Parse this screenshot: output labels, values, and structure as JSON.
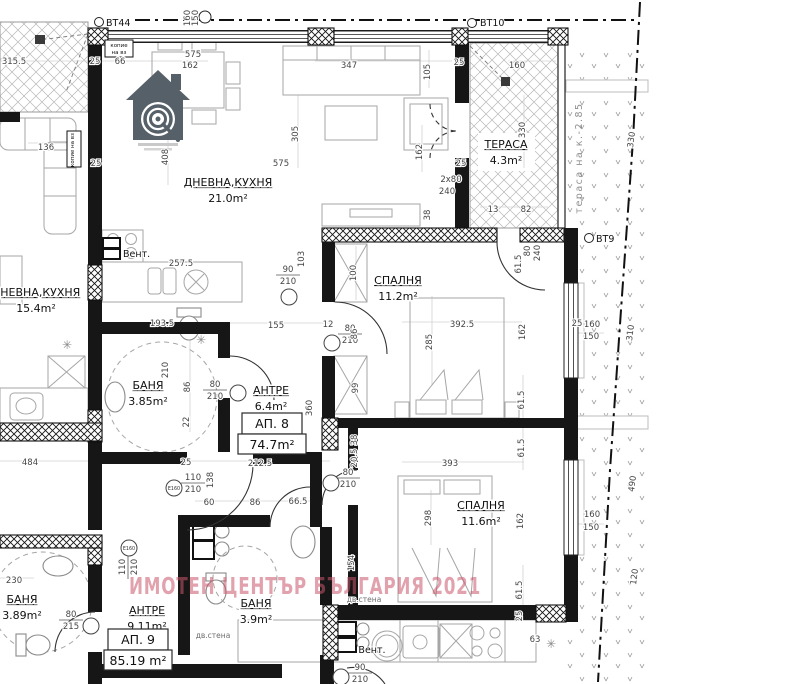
{
  "watermark": {
    "text": "ИМОТЕН ЦЕНТЪР БЪЛГАРИЯ 2021",
    "color": "#c9566b"
  },
  "logo": {
    "icon": "house-target-logo"
  },
  "rooms": [
    {
      "id": "living-21",
      "name": "ДНЕВНА,КУХНЯ",
      "area": "21.0m²",
      "x": 228,
      "y": 186
    },
    {
      "id": "terrace-4-3",
      "name": "ТЕРАСА",
      "area": "4.3m²",
      "x": 506,
      "y": 148
    },
    {
      "id": "living-15-4",
      "name": "ДНЕВНА,КУХНЯ",
      "area": "15.4m²",
      "x": 36,
      "y": 296
    },
    {
      "id": "bedroom-11-2",
      "name": "СПАЛНЯ",
      "area": "11.2m²",
      "x": 398,
      "y": 284
    },
    {
      "id": "bath-3-85",
      "name": "БАНЯ",
      "area": "3.85m²",
      "x": 148,
      "y": 389
    },
    {
      "id": "hall-6-4",
      "name": "АНТРЕ",
      "area": "6.4m²",
      "x": 271,
      "y": 394
    },
    {
      "id": "bedroom-11-6",
      "name": "СПАЛНЯ",
      "area": "11.6m²",
      "x": 481,
      "y": 509
    },
    {
      "id": "bath-3-89",
      "name": "БАНЯ",
      "area": "3.89m²",
      "x": 22,
      "y": 603
    },
    {
      "id": "hall-9-11",
      "name": "АНТРЕ",
      "area": "9.11m²",
      "x": 147,
      "y": 614
    },
    {
      "id": "bath-3-9",
      "name": "БАНЯ",
      "area": "3.9m²",
      "x": 256,
      "y": 607
    }
  ],
  "apartments": [
    {
      "label": "АП. 8",
      "area": "74.7m²",
      "x": 272,
      "y": 413
    },
    {
      "label": "АП. 9",
      "area": "85.19 m²",
      "x": 138,
      "y": 629
    }
  ],
  "annotations": [
    {
      "t": "ВТ44",
      "x": 106,
      "y": 26,
      "a": "start",
      "c": "ann"
    },
    {
      "t": "ВТ10",
      "x": 480,
      "y": 26,
      "a": "start",
      "c": "ann"
    },
    {
      "t": "ВТ9",
      "x": 596,
      "y": 242,
      "a": "start",
      "c": "ann"
    },
    {
      "t": "Вент.",
      "x": 123,
      "y": 257,
      "a": "start",
      "c": "ann"
    },
    {
      "t": "Вент.",
      "x": 372,
      "y": 653,
      "c": "ann"
    },
    {
      "t": "дв.стена",
      "x": 213,
      "y": 638,
      "c": "small-gray"
    },
    {
      "t": "дв.стена",
      "x": 364,
      "y": 602,
      "c": "small-gray"
    },
    {
      "t": "тераса на к.-2.85",
      "x": 582,
      "y": 158,
      "r": -90,
      "c": "gray-vert"
    },
    {
      "t": "копие",
      "x": 119,
      "y": 47,
      "c": "tiny"
    },
    {
      "t": "на вз",
      "x": 119,
      "y": 54,
      "c": "tiny"
    },
    {
      "t": "копие на вз",
      "x": 74,
      "y": 150,
      "r": -90,
      "c": "tiny"
    },
    {
      "t": "✳",
      "x": 201,
      "y": 344,
      "c": "lamp"
    },
    {
      "t": "✳",
      "x": 67,
      "y": 349,
      "c": "lamp"
    },
    {
      "t": "✳",
      "x": 551,
      "y": 648,
      "c": "lamp"
    }
  ],
  "dimensions": [
    {
      "t": "315.5",
      "x": 14,
      "y": 64
    },
    {
      "t": "25",
      "x": 95,
      "y": 64
    },
    {
      "t": "66",
      "x": 120,
      "y": 64
    },
    {
      "t": "575",
      "x": 193,
      "y": 57
    },
    {
      "t": "162",
      "x": 190,
      "y": 68
    },
    {
      "t": "347",
      "x": 349,
      "y": 68
    },
    {
      "t": "105",
      "x": 430,
      "y": 72,
      "r": -90
    },
    {
      "t": "305",
      "x": 298,
      "y": 134,
      "r": -90
    },
    {
      "t": "575",
      "x": 281,
      "y": 166
    },
    {
      "t": "408",
      "x": 168,
      "y": 157,
      "r": -90
    },
    {
      "t": "136",
      "x": 46,
      "y": 150
    },
    {
      "t": "25",
      "x": 96,
      "y": 166
    },
    {
      "t": "160",
      "x": 517,
      "y": 68
    },
    {
      "t": "330",
      "x": 525,
      "y": 130,
      "r": -90
    },
    {
      "t": "13",
      "x": 493,
      "y": 212
    },
    {
      "t": "82",
      "x": 526,
      "y": 212
    },
    {
      "t": "25",
      "x": 459,
      "y": 65
    },
    {
      "t": "162",
      "x": 422,
      "y": 152,
      "r": -90
    },
    {
      "t": "2x80",
      "x": 451,
      "y": 182
    },
    {
      "t": "240",
      "x": 447,
      "y": 194
    },
    {
      "t": "25",
      "x": 461,
      "y": 166
    },
    {
      "t": "38",
      "x": 430,
      "y": 215,
      "r": -90
    },
    {
      "t": "160",
      "x": 190,
      "y": 18,
      "r": -90
    },
    {
      "t": "150",
      "x": 198,
      "y": 18,
      "r": -90
    },
    {
      "t": "257.5",
      "x": 181,
      "y": 266
    },
    {
      "t": "193.5",
      "x": 162,
      "y": 326
    },
    {
      "t": "210",
      "x": 168,
      "y": 370,
      "r": -90
    },
    {
      "t": "86",
      "x": 190,
      "y": 387,
      "r": -90
    },
    {
      "t": "22",
      "x": 189,
      "y": 422,
      "r": -90
    },
    {
      "t": "103",
      "x": 304,
      "y": 259,
      "r": -90
    },
    {
      "t": "100",
      "x": 356,
      "y": 273,
      "r": -90
    },
    {
      "t": "155",
      "x": 276,
      "y": 328
    },
    {
      "t": "12",
      "x": 328,
      "y": 327
    },
    {
      "t": "86",
      "x": 357,
      "y": 334,
      "r": -90
    },
    {
      "t": "99",
      "x": 358,
      "y": 388,
      "r": -90
    },
    {
      "t": "360",
      "x": 312,
      "y": 408,
      "r": -90
    },
    {
      "t": "392.5",
      "x": 462,
      "y": 327
    },
    {
      "t": "285",
      "x": 432,
      "y": 342,
      "r": -90
    },
    {
      "t": "61.5",
      "x": 521,
      "y": 264,
      "r": -90
    },
    {
      "t": "80",
      "x": 530,
      "y": 251,
      "r": -90
    },
    {
      "t": "240",
      "x": 540,
      "y": 253,
      "r": -90
    },
    {
      "t": "162",
      "x": 525,
      "y": 332,
      "r": -90
    },
    {
      "t": "61.5",
      "x": 524,
      "y": 400,
      "r": -90
    },
    {
      "t": "61.5",
      "x": 524,
      "y": 448,
      "r": -90
    },
    {
      "t": "25",
      "x": 577,
      "y": 326
    },
    {
      "t": "160",
      "x": 592,
      "y": 327
    },
    {
      "t": "150",
      "x": 591,
      "y": 339
    },
    {
      "t": "330",
      "x": 634,
      "y": 140,
      "r": -83
    },
    {
      "t": "310",
      "x": 633,
      "y": 333,
      "r": -83
    },
    {
      "t": "490",
      "x": 635,
      "y": 484,
      "r": -83
    },
    {
      "t": "120",
      "x": 637,
      "y": 577,
      "r": -83
    },
    {
      "t": "38",
      "x": 357,
      "y": 440,
      "r": -90
    },
    {
      "t": "20.5",
      "x": 357,
      "y": 458,
      "r": -90
    },
    {
      "t": "212.5",
      "x": 260,
      "y": 466
    },
    {
      "t": "138",
      "x": 213,
      "y": 480,
      "r": -90
    },
    {
      "t": "25",
      "x": 186,
      "y": 465
    },
    {
      "t": "60",
      "x": 209,
      "y": 505
    },
    {
      "t": "86",
      "x": 255,
      "y": 505
    },
    {
      "t": "484",
      "x": 30,
      "y": 465
    },
    {
      "t": "230",
      "x": 14,
      "y": 583
    },
    {
      "t": "66.5",
      "x": 298,
      "y": 504
    },
    {
      "t": "393",
      "x": 450,
      "y": 466
    },
    {
      "t": "298",
      "x": 431,
      "y": 518,
      "r": -90
    },
    {
      "t": "162",
      "x": 523,
      "y": 521,
      "r": -90
    },
    {
      "t": "154",
      "x": 354,
      "y": 563,
      "r": -90
    },
    {
      "t": "61.5",
      "x": 522,
      "y": 590,
      "r": -90
    },
    {
      "t": "160",
      "x": 592,
      "y": 517
    },
    {
      "t": "150",
      "x": 591,
      "y": 530
    },
    {
      "t": "63",
      "x": 535,
      "y": 642
    },
    {
      "t": "25",
      "x": 522,
      "y": 616,
      "r": -90
    }
  ],
  "door_markers": [
    {
      "w": "90",
      "h": "210",
      "x": 288,
      "y": 272,
      "cx": 289,
      "cy": 297
    },
    {
      "w": "80",
      "h": "210",
      "x": 350,
      "y": 331,
      "cx": 332,
      "cy": 343
    },
    {
      "w": "80",
      "h": "210",
      "x": 215,
      "y": 387,
      "cx": 238,
      "cy": 393
    },
    {
      "w": "80",
      "h": "210",
      "x": 348,
      "y": 475,
      "cx": 331,
      "cy": 483
    },
    {
      "w": "80",
      "h": "215",
      "x": 71,
      "y": 617,
      "cx": 91,
      "cy": 626
    },
    {
      "w": "110",
      "h": "210",
      "x": 193,
      "y": 480,
      "cx": 174,
      "cy": 488,
      "e": "E160"
    },
    {
      "w": "110",
      "h": "210",
      "x": 125,
      "y": 567,
      "r": -90,
      "cx": 129,
      "cy": 548,
      "e": "E160"
    },
    {
      "w": "90",
      "h": "210",
      "x": 360,
      "y": 670,
      "cx": 341,
      "cy": 677
    }
  ]
}
